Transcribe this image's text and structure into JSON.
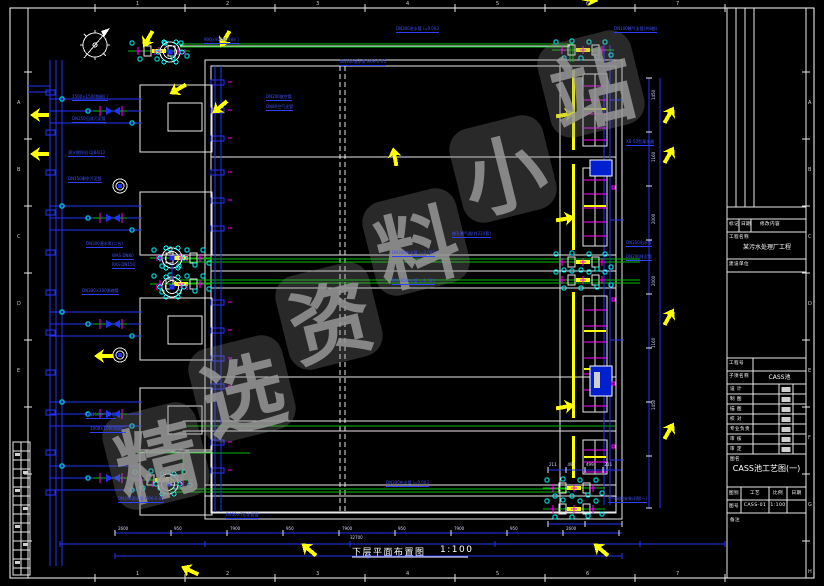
{
  "watermark": {
    "text": "精选资料小站",
    "chars": [
      "精",
      "选",
      "资",
      "料",
      "小",
      "站"
    ],
    "positions": [
      [
        108,
        408
      ],
      [
        194,
        341
      ],
      [
        281,
        268
      ],
      [
        368,
        194
      ],
      [
        455,
        121
      ],
      [
        543,
        36
      ]
    ],
    "color": "#8c8c8c"
  },
  "caption": {
    "title": "下层平面布置图",
    "scale": "1:100"
  },
  "frame": {
    "grid_numbers": [
      "1",
      "2",
      "3",
      "4",
      "5",
      "6",
      "7"
    ],
    "grid_letters_right": [
      "A",
      "B",
      "C",
      "D",
      "E",
      "F",
      "G",
      "H"
    ],
    "grid_letters_left": [
      "A",
      "B",
      "C",
      "D",
      "E"
    ]
  },
  "colors": {
    "pipe_blue": "#2433ff",
    "pipe_green": "#00c000",
    "fitting_cyan": "#00ffff",
    "valve_magenta": "#ff00ff",
    "marker_yellow": "#ffff00",
    "wall_white": "#e8e8e8"
  },
  "annotations": [
    {
      "text": "DN300进水管 i=0.003",
      "x": 396,
      "y": 27
    },
    {
      "text": "DN100曝气支管(共8根)",
      "x": 614,
      "y": 27
    },
    {
      "text": "DN300潜水泵 M06-0.05",
      "x": 340,
      "y": 60
    },
    {
      "text": "900×900铸铁闸门",
      "x": 204,
      "y": 38
    },
    {
      "text": "DN200放空管",
      "x": 266,
      "y": 95
    },
    {
      "text": "DN80空气支管",
      "x": 266,
      "y": 105
    },
    {
      "text": "1500×1500钢闸门",
      "x": 72,
      "y": 95
    },
    {
      "text": "DN250回流污泥管",
      "x": 72,
      "y": 117
    },
    {
      "text": "潜水搅拌机 QJB4/12",
      "x": 68,
      "y": 151
    },
    {
      "text": "DN150剩余污泥管",
      "x": 68,
      "y": 177
    },
    {
      "text": "XB-50型滗水器",
      "x": 626,
      "y": 140
    },
    {
      "text": "DN300潜水泵(二台)",
      "x": 86,
      "y": 242
    },
    {
      "text": "WAS-DN80",
      "x": 112,
      "y": 254
    },
    {
      "text": "RAS-DN150",
      "x": 112,
      "y": 263
    },
    {
      "text": "DN300×200渐缩管",
      "x": 82,
      "y": 289
    },
    {
      "text": "DN300布水管 i=0.003",
      "x": 392,
      "y": 251
    },
    {
      "text": "DN300布水管 i=0.003",
      "x": 392,
      "y": 279
    },
    {
      "text": "DN350出水管",
      "x": 626,
      "y": 241
    },
    {
      "text": "DN200排泥管",
      "x": 626,
      "y": 255
    },
    {
      "text": "微孔曝气器(共224套)",
      "x": 452,
      "y": 232
    },
    {
      "text": "DN250空气总管",
      "x": 86,
      "y": 413
    },
    {
      "text": "1000×1000钢闸门",
      "x": 90,
      "y": 427
    },
    {
      "text": "DN300潜水泵 M06-0.05",
      "x": 118,
      "y": 497
    },
    {
      "text": "D450×7防水套管",
      "x": 226,
      "y": 513
    },
    {
      "text": "DN300布水管 i=0.003",
      "x": 386,
      "y": 481
    },
    {
      "text": "空气阀组安装详图(一)",
      "x": 608,
      "y": 497
    }
  ],
  "dims": {
    "bottom": [
      "2600",
      "950",
      "7900",
      "950",
      "7900",
      "950",
      "7900",
      "950",
      "2600"
    ],
    "bottom_total": "32700",
    "right": [
      "1450",
      "1160",
      "2000",
      "2000",
      "1160",
      "1450"
    ],
    "detail": [
      "211",
      "499",
      "499",
      "211"
    ]
  },
  "title_block": {
    "revision": [
      "标记",
      "日期",
      "修改内容"
    ],
    "project_label": "工程名称",
    "project_name": "某污水处理厂工程",
    "client_label": "建设单位",
    "job_no_label": "工程号",
    "subitem_label": "子项名称",
    "subitem_value": "CASS池",
    "sign_rows": [
      "设 计",
      "制 图",
      "描 图",
      "校 对",
      "专业负责",
      "审 核",
      "审 定"
    ],
    "date_label": "日期",
    "title_label": "图名",
    "drawing_title": "CASS池工艺图(一)",
    "footer_row1": [
      "图别",
      "工艺",
      "比例",
      "日期"
    ],
    "footer_row2": [
      "图号",
      "CASS-01",
      "1:100",
      ""
    ],
    "note_label": "备注"
  }
}
